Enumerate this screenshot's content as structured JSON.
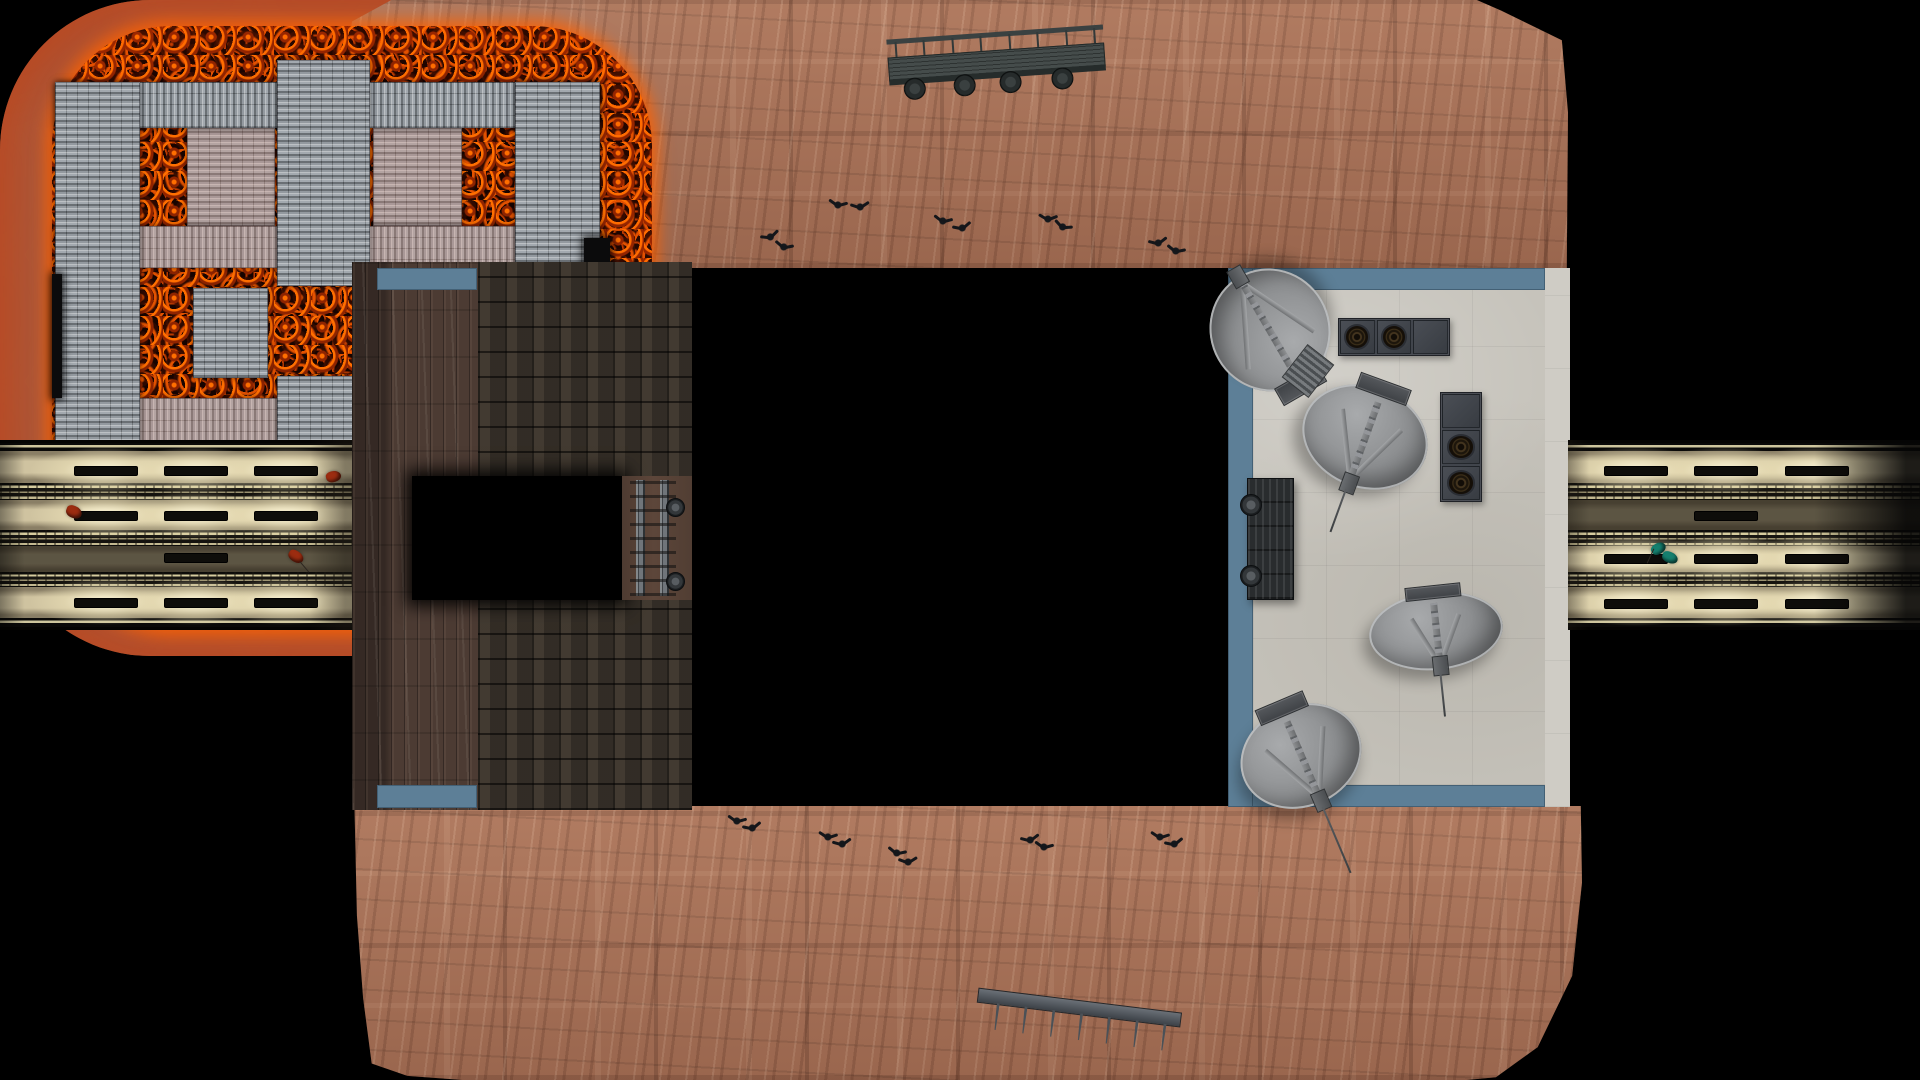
{
  "scene": {
    "description": "Top-down overhead view of a volcanic arena game map: central lava pit crossed by corrugated metal walkways, wooden mine building with brick paths on the left, concrete satellite-dish yard on the right, and two lit rail tunnels exiting left and right.",
    "background_color": "#000000"
  },
  "palette": {
    "rock": "#a87258",
    "lava_glow": "#ff6f00",
    "lava_dark": "#170400",
    "grate_gray": "#9aa0a6",
    "grate_pink_tint": "rgba(230,150,128,0.26)",
    "wood": "#4c3b33",
    "brick": "#3a332b",
    "blue_trim": "#5d7f97",
    "concrete": "#c6c3bb",
    "tunnel_light": "#fdf6d8",
    "metal_dark": "#3c4147",
    "debris_red": "#9c2c10",
    "debris_teal": "#15806f"
  },
  "props": {
    "satellite_dishes": [
      {
        "id": "dish-top-left",
        "x": 1210,
        "y": 268,
        "w": 120,
        "h": 124,
        "rot": 150,
        "needle": 0
      },
      {
        "id": "dish-center",
        "x": 1301,
        "y": 386,
        "w": 128,
        "h": 102,
        "rot": 20,
        "needle": 46
      },
      {
        "id": "dish-bottom-right",
        "x": 1369,
        "y": 592,
        "w": 134,
        "h": 78,
        "rot": -6,
        "needle": 44
      },
      {
        "id": "dish-bottom-left",
        "x": 1239,
        "y": 705,
        "w": 124,
        "h": 102,
        "rot": -23,
        "needle": 72
      }
    ],
    "fan_units": [
      {
        "id": "fan-unit-top",
        "x": 1338,
        "y": 318,
        "w": 110,
        "h": 36,
        "orientation": "h",
        "cells": [
          "fan",
          "fan",
          "lid"
        ]
      },
      {
        "id": "fan-unit-right",
        "x": 1440,
        "y": 392,
        "w": 40,
        "h": 108,
        "orientation": "v",
        "cells": [
          "lid",
          "fan",
          "fan"
        ]
      }
    ],
    "truss_ladder": {
      "x": 1291,
      "y": 350,
      "w": 32,
      "h": 40,
      "rot": 38
    },
    "rail_car_right": {
      "x": 1247,
      "y": 478,
      "w": 45,
      "h": 120,
      "wheels": [
        {
          "dx": -8,
          "dy": 15
        },
        {
          "dx": -8,
          "dy": 86
        }
      ]
    },
    "train_bridge_top": {
      "x": 888,
      "y": 26,
      "w": 217,
      "h": 68,
      "rot": -4,
      "posts": 8,
      "wheels": [
        24,
        74,
        120,
        172
      ]
    },
    "fence_bottom": {
      "x": 975,
      "y": 1000,
      "w": 205,
      "h": 46,
      "rot": 7,
      "posts": [
        20,
        48,
        76,
        104,
        132,
        160,
        188
      ]
    },
    "birds": [
      {
        "x": 770,
        "y": 236,
        "rot": -20
      },
      {
        "x": 784,
        "y": 246,
        "rot": 15
      },
      {
        "x": 838,
        "y": 204,
        "rot": 10
      },
      {
        "x": 860,
        "y": 206,
        "rot": -8
      },
      {
        "x": 943,
        "y": 220,
        "rot": 12
      },
      {
        "x": 962,
        "y": 227,
        "rot": -15
      },
      {
        "x": 1048,
        "y": 218,
        "rot": 5
      },
      {
        "x": 1063,
        "y": 226,
        "rot": 22
      },
      {
        "x": 1158,
        "y": 242,
        "rot": -12
      },
      {
        "x": 1176,
        "y": 250,
        "rot": 14
      },
      {
        "x": 737,
        "y": 820,
        "rot": 10
      },
      {
        "x": 752,
        "y": 827,
        "rot": -14
      },
      {
        "x": 828,
        "y": 836,
        "rot": 8
      },
      {
        "x": 842,
        "y": 843,
        "rot": -10
      },
      {
        "x": 897,
        "y": 852,
        "rot": 14
      },
      {
        "x": 908,
        "y": 861,
        "rot": -6
      },
      {
        "x": 1030,
        "y": 839,
        "rot": -12
      },
      {
        "x": 1044,
        "y": 846,
        "rot": 10
      },
      {
        "x": 1160,
        "y": 836,
        "rot": 8
      },
      {
        "x": 1174,
        "y": 843,
        "rot": -14
      }
    ],
    "debris_red": [
      {
        "x": 74,
        "y": 512,
        "w": 16,
        "h": 12,
        "rot": 20
      },
      {
        "x": 333,
        "y": 476,
        "w": 15,
        "h": 11,
        "rot": -15
      },
      {
        "x": 296,
        "y": 556,
        "w": 16,
        "h": 11,
        "rot": 30
      }
    ],
    "debris_teal": [
      {
        "x": 1658,
        "y": 548,
        "w": 15,
        "h": 11,
        "rot": -35
      },
      {
        "x": 1670,
        "y": 557,
        "w": 16,
        "h": 11,
        "rot": 20
      }
    ],
    "tunnel_lights_left": [
      {
        "x": 105,
        "y": 470,
        "pool": true
      },
      {
        "x": 195,
        "y": 470,
        "pool": true
      },
      {
        "x": 285,
        "y": 470,
        "pool": true
      },
      {
        "x": 105,
        "y": 515,
        "pool": true
      },
      {
        "x": 195,
        "y": 515,
        "pool": true
      },
      {
        "x": 285,
        "y": 515,
        "pool": true
      },
      {
        "x": 195,
        "y": 557,
        "pool": false
      },
      {
        "x": 105,
        "y": 602,
        "pool": true
      },
      {
        "x": 195,
        "y": 602,
        "pool": true
      },
      {
        "x": 285,
        "y": 602,
        "pool": true
      }
    ],
    "tunnel_lights_right": [
      {
        "x": 1635,
        "y": 470,
        "pool": true
      },
      {
        "x": 1725,
        "y": 470,
        "pool": true
      },
      {
        "x": 1816,
        "y": 470,
        "pool": true
      },
      {
        "x": 1725,
        "y": 515,
        "pool": false
      },
      {
        "x": 1635,
        "y": 558,
        "pool": true
      },
      {
        "x": 1725,
        "y": 558,
        "pool": true
      },
      {
        "x": 1816,
        "y": 558,
        "pool": true
      },
      {
        "x": 1635,
        "y": 603,
        "pool": true
      },
      {
        "x": 1725,
        "y": 603,
        "pool": true
      },
      {
        "x": 1816,
        "y": 603,
        "pool": true
      }
    ]
  }
}
